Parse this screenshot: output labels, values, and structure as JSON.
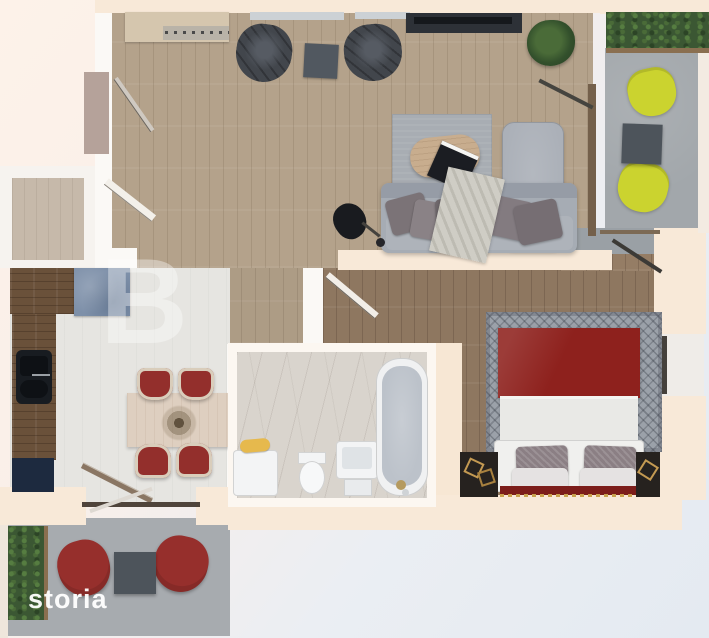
{
  "image": {
    "kind": "3d-apartment-floor-plan-render",
    "width_px": 709,
    "height_px": 638
  },
  "watermarks": {
    "brand_logo": "storia",
    "faint_overlay_letter": "B"
  },
  "palette": {
    "wall_peach": "#f8e9d8",
    "wall_white": "#fbf9f6",
    "living_wood": "#b4a28b",
    "bedroom_wood": "#8e7760",
    "kitchen_floor": "#e6e5e1",
    "bathroom_marble": "#d9d4cd",
    "balcony_concrete": "#a2a7ab",
    "counter_wood": "#6a513a",
    "cabinet_steel_blue": "#7e90a9",
    "appliance_navy": "#1d2a3f",
    "sofa_gray": "#a6acb4",
    "armchair_black": "#42464c",
    "bed_blanket_dark_red": "#8e211d",
    "bed_sheet_white": "#e9e9e6",
    "dining_chair_red": "#932f2c",
    "balcony_chair_red": "#962f2c",
    "balcony_chair_yellow": "#cbd32f",
    "hedge_green": "#3b5733",
    "towel_yellow": "#e6b94d",
    "background_top_left": "#fdf2e9",
    "background_bottom_right": "#e4eaf1"
  },
  "rooms": [
    {
      "id": "living-room",
      "floor": "light oak planks",
      "furniture": [
        "sideboard",
        "black armchair x2",
        "small side table",
        "tv console",
        "potted plant",
        "area rug",
        "round coffee table",
        "laptop",
        "gray sofa with pillows",
        "gray chaise lounge",
        "throw blanket",
        "black floor lamp",
        "balcony door",
        "entry door"
      ]
    },
    {
      "id": "entry-hall",
      "floor": "taupe",
      "furniture": [
        "interior door"
      ]
    },
    {
      "id": "kitchen-dining",
      "floor": "light gray",
      "furniture": [
        "L-shaped rustic counter",
        "black double sink",
        "steel-blue cabinet",
        "navy appliance",
        "dining table",
        "red dining chair x4",
        "twig centerpiece",
        "balcony sliding door"
      ]
    },
    {
      "id": "hallway",
      "floor": "oak planks",
      "furniture": [
        "bedroom door",
        "bathroom door"
      ]
    },
    {
      "id": "bathroom",
      "floor": "marble",
      "furniture": [
        "washing machine",
        "yellow towel",
        "toilet",
        "sink vanity",
        "bathtub with chrome faucet"
      ]
    },
    {
      "id": "bedroom",
      "floor": "dark walnut planks",
      "furniture": [
        "double bed with dark red blanket",
        "white sheets",
        "gray pillows x2",
        "white pillows x2",
        "patterned gray rug",
        "nightstand x2",
        "gold geometric decor",
        "window",
        "balcony door"
      ]
    },
    {
      "id": "balcony-right",
      "floor": "concrete",
      "furniture": [
        "hedge planter",
        "yellow lounge chair x2",
        "dark gray side table"
      ]
    },
    {
      "id": "balcony-lower-left",
      "floor": "concrete",
      "furniture": [
        "hedge planter",
        "red lounge chair x2",
        "dark gray side table",
        "sliding glass door"
      ]
    }
  ]
}
